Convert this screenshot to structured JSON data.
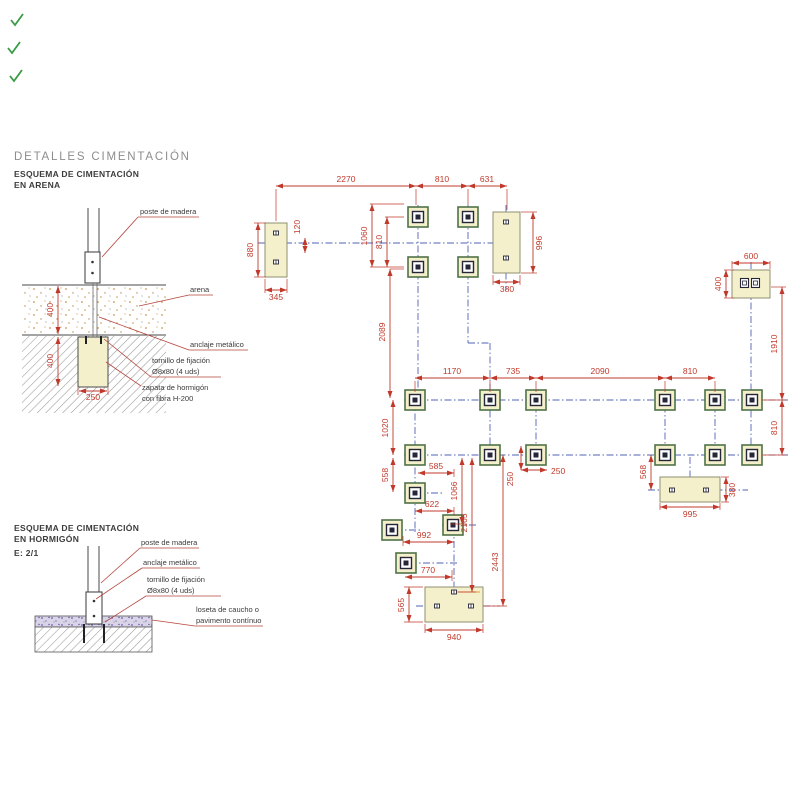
{
  "header": {
    "title": "DETALLES  CIMENTACIÓN",
    "subtitle1": "ESQUEMA DE CIMENTACIÓN",
    "subtitle2": "EN ARENA"
  },
  "arena": {
    "labels": {
      "poste": "poste de madera",
      "arena": "arena",
      "anclaje": "anclaje metálico",
      "tornillo1": "tornillo de fijación",
      "tornillo2": "Ø8x80 (4 uds)",
      "zapata1": "zapata de hormigón",
      "zapata2": "con fibra H-200"
    },
    "dims": {
      "sand_depth": "400",
      "footing_depth": "400",
      "footing_width": "250"
    }
  },
  "hormigon": {
    "title1": "ESQUEMA DE CIMENTACIÓN",
    "title2": "EN HORMIGÓN",
    "scale": "E: 2/1",
    "labels": {
      "poste": "poste de madera",
      "anclaje": "anclaje metálico",
      "tornillo1": "tornillo de fijación",
      "tornillo2": "Ø8x80 (4 uds)",
      "loseta1": "loseta de caucho o",
      "loseta2": "pavimento contínuo"
    }
  },
  "plan": {
    "colors": {
      "dimension": "#c0392b",
      "centerline": "#5163b5",
      "pad_border": "#4f7246",
      "footing_fill": "#f4f0cc",
      "sand_dot": "#c8974f",
      "rubber": "#8a7ec0"
    },
    "dims": {
      "top_2270": "2270",
      "top_810": "810",
      "top_631": "631",
      "left_880": "880",
      "left_345": "345",
      "left_120": "120",
      "cluster_1060": "1060",
      "cluster_810": "810",
      "right_996": "996",
      "right_380": "380",
      "fr_600": "600",
      "fr_400": "400",
      "fr_1910": "1910",
      "fr_810": "810",
      "mid_1170": "1170",
      "mid_735": "735",
      "mid_2090": "2090",
      "mid_810": "810",
      "v_2089": "2089",
      "v_1020": "1020",
      "v_558": "558",
      "s_585": "585",
      "s_622": "622",
      "s_992": "992",
      "s_770": "770",
      "v_1066": "1066",
      "v_2165": "2165",
      "v_2443": "2443",
      "s_250v": "250",
      "s_250h": "250",
      "r_568": "568",
      "r_995": "995",
      "r_380": "380",
      "b_565": "565",
      "b_940": "940"
    }
  }
}
